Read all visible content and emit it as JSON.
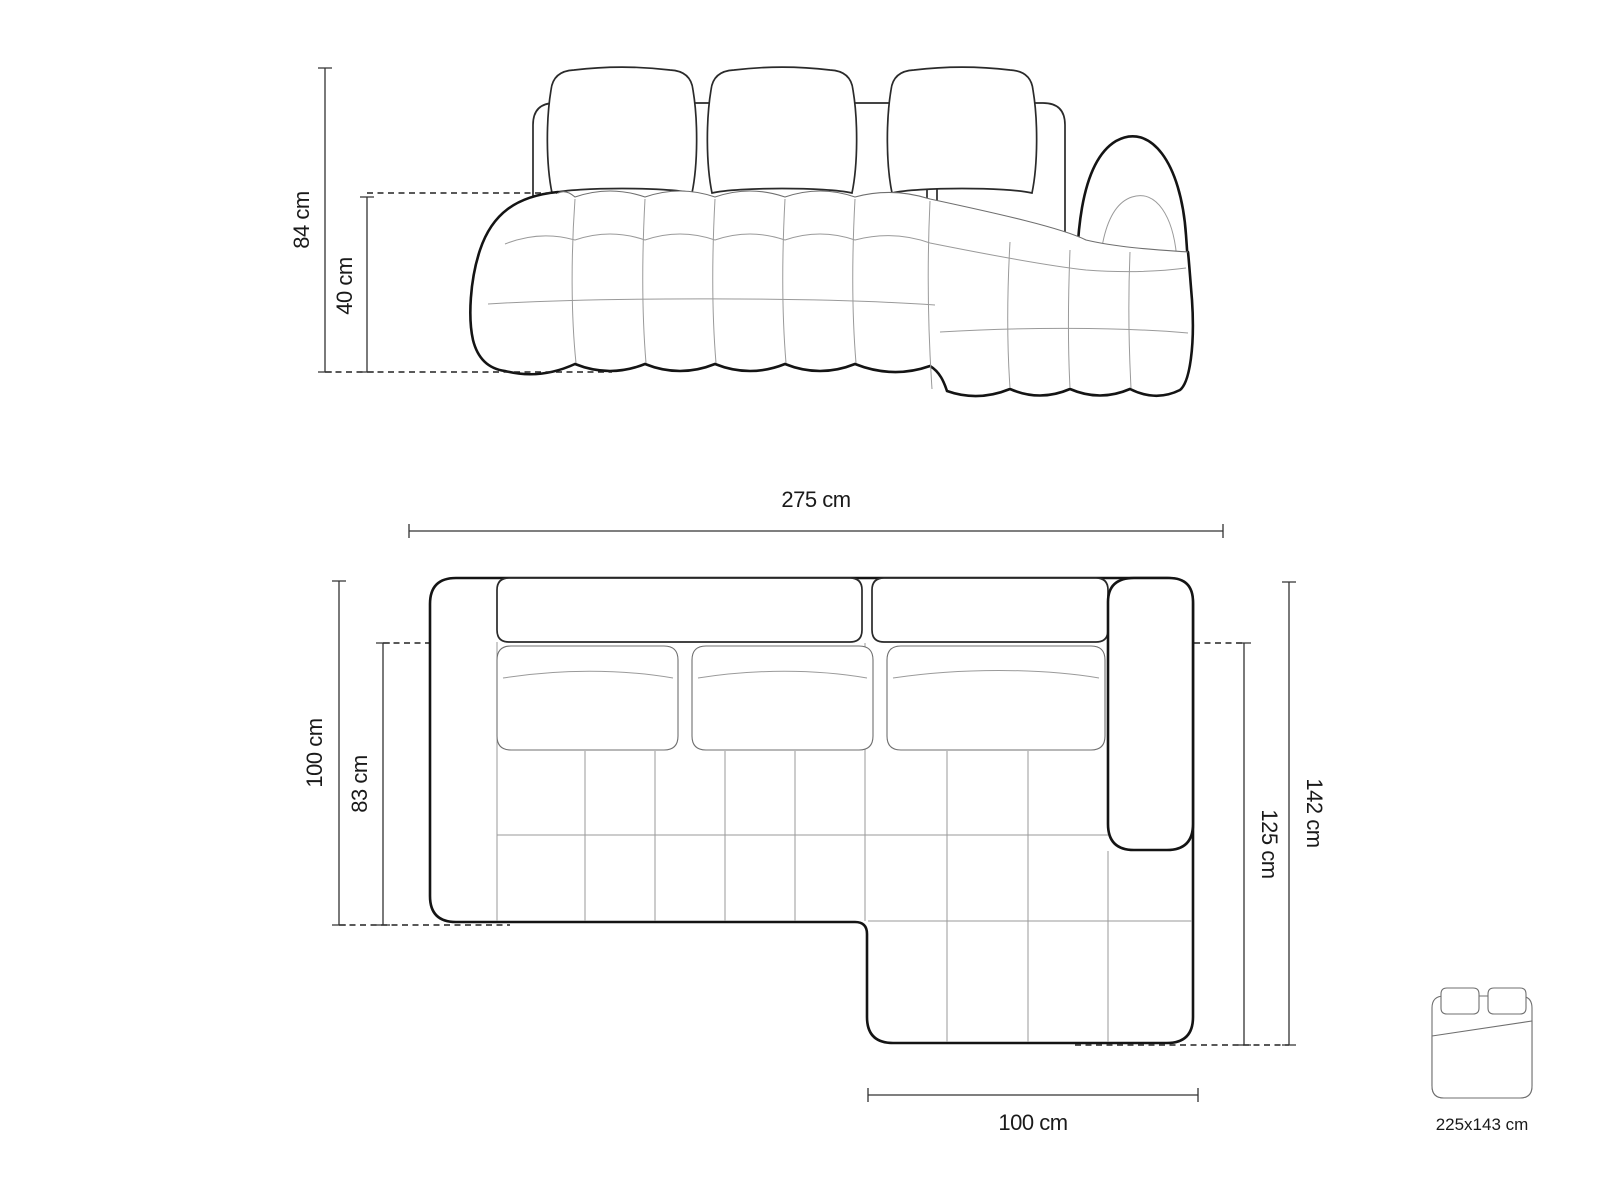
{
  "page": {
    "title": "Corner sofa dimension drawing",
    "background": "#ffffff",
    "line_color": "#141414"
  },
  "front_view": {
    "dimensions": {
      "total_height": "84 cm",
      "seat_height": "40 cm"
    }
  },
  "top_view": {
    "dimensions": {
      "total_width": "275 cm",
      "total_depth": "100 cm",
      "seat_depth": "83 cm",
      "total_side_depth": "142 cm",
      "chaise_depth": "125 cm",
      "chaise_width": "100 cm"
    }
  },
  "sleeping_area": {
    "size_label": "225x143 cm"
  }
}
